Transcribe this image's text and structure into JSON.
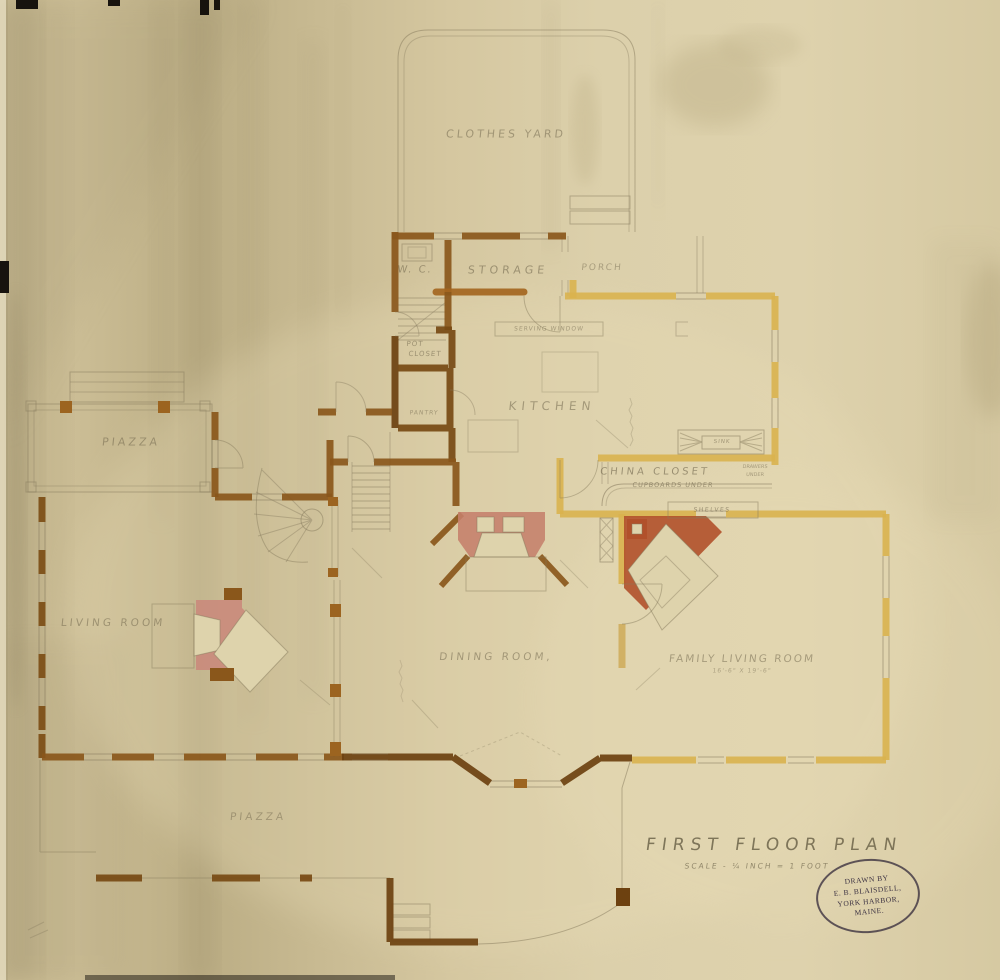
{
  "palette": {
    "paper": "#d8cba4",
    "paper_shadow": "#b3a67e",
    "paper_light": "#e8dcb6",
    "pencil": "#85795c",
    "wall_ochre": "#d9b24f",
    "wall_umber": "#8a571b",
    "wall_umber_dark": "#6d4110",
    "chimney_red_center": "#c5806b",
    "chimney_red_corner": "#b1512b",
    "chimney_red_living": "#c9897b",
    "photo_edge_black": "#17130e",
    "stamp_ink": "#3d3343"
  },
  "labels": {
    "clothes_yard": "CLOTHES YARD",
    "wc": "W. C.",
    "storage": "STORAGE",
    "porch": "PORCH",
    "serving_window": "SERVING WINDOW",
    "pot": "POT",
    "closet": "CLOSET",
    "pantry": "PANTRY",
    "kitchen": "KITCHEN",
    "china_closet": "CHINA CLOSET",
    "cupboards_under": "CUPBOARDS UNDER",
    "sink": "SINK",
    "drawers_line1": "DRAWERS",
    "drawers_line2": "UNDER",
    "shelves": "SHELVES",
    "piazza_left": "PIAZZA",
    "living_room": "LIVING ROOM",
    "dining_room": "DINING ROOM,",
    "family_living_room": "FAMILY LIVING ROOM",
    "flr_dimension": "16'-6\" X 19'-6\"",
    "piazza_bottom": "PIAZZA"
  },
  "title_block": {
    "title": "FIRST FLOOR PLAN",
    "scale_note": "SCALE - ¼ INCH = 1 FOOT"
  },
  "stamp": {
    "lines": [
      "DRAWN BY",
      "E. B. BLAISDELL,",
      "YORK HARBOR,",
      "MAINE."
    ]
  }
}
